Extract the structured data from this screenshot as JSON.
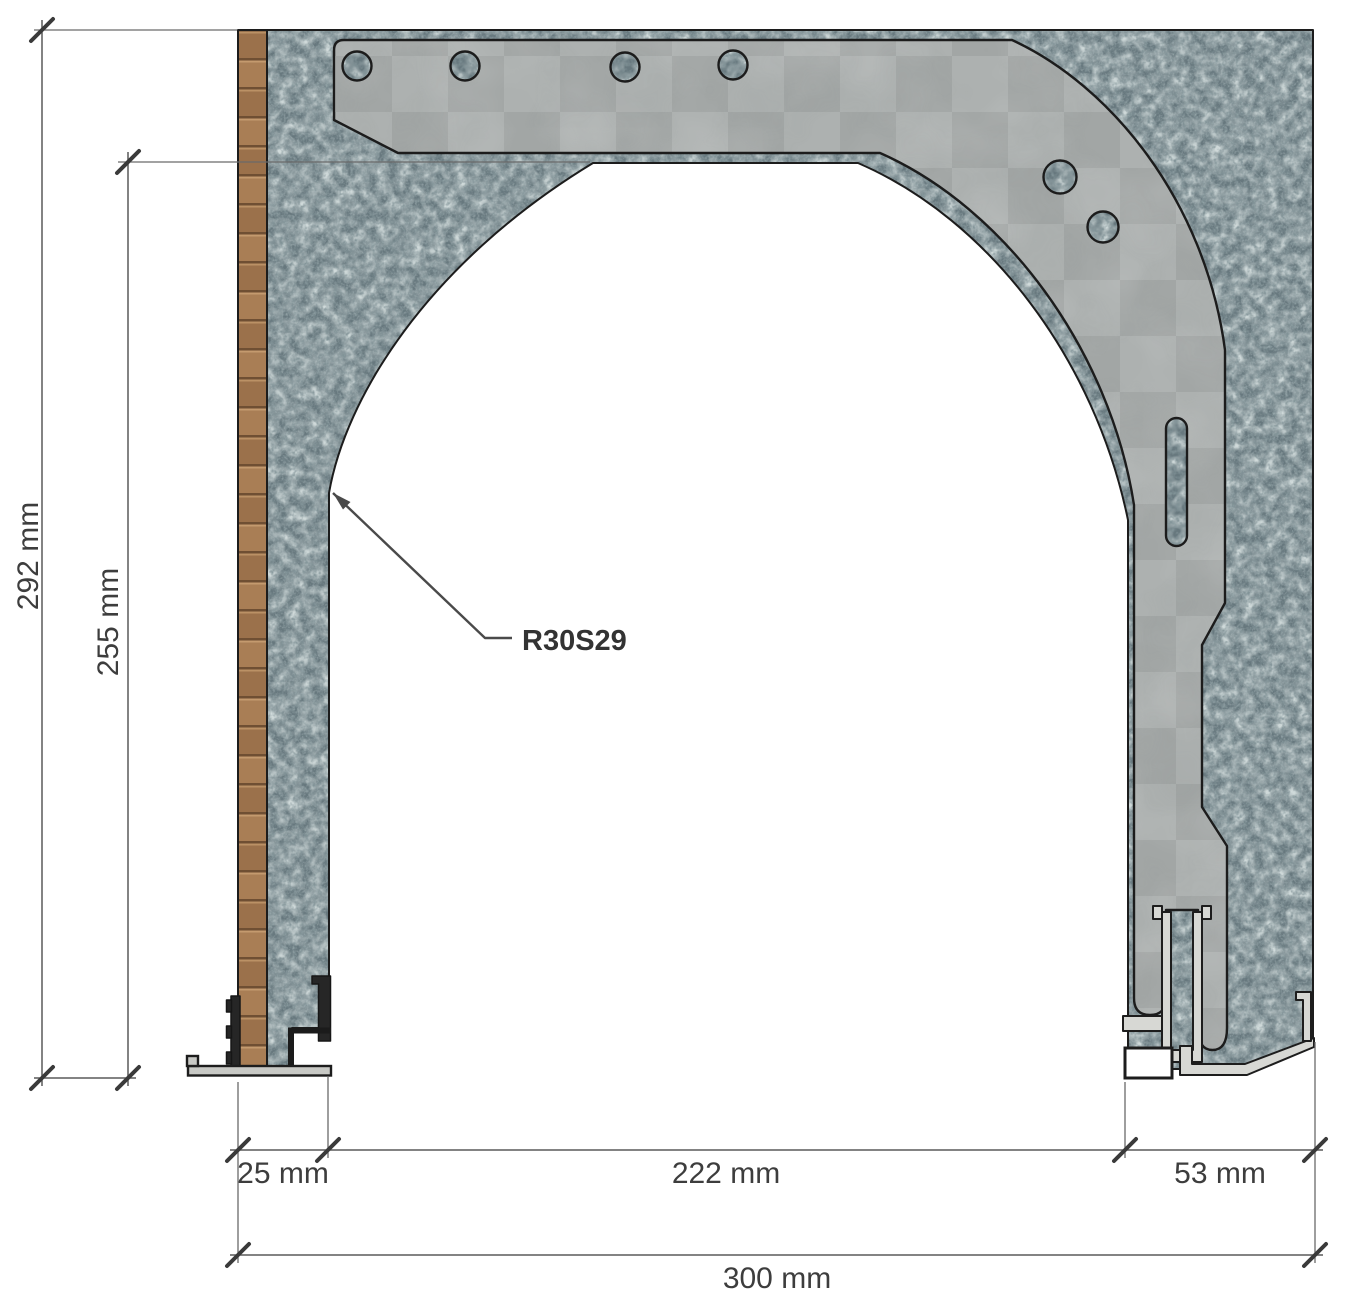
{
  "drawing": {
    "part_code": "R30S29",
    "dimensions": {
      "overall_height": "292 mm",
      "opening_height": "255 mm",
      "left_wall": "25 mm",
      "opening_width": "222 mm",
      "right_wall": "53 mm",
      "overall_width": "300 mm"
    },
    "colors": {
      "insulation_base": "#67787e",
      "insulation_light": "#9fb1b2",
      "insulation_dark": "#39474d",
      "board_gray": "#a8acab",
      "wood_brown": "#a97e55",
      "aluminum": "#d7d8d4",
      "outline": "#1c1c1c",
      "dimension_text": "#3d3d3d",
      "dimension_line": "#5a5a5a"
    }
  }
}
